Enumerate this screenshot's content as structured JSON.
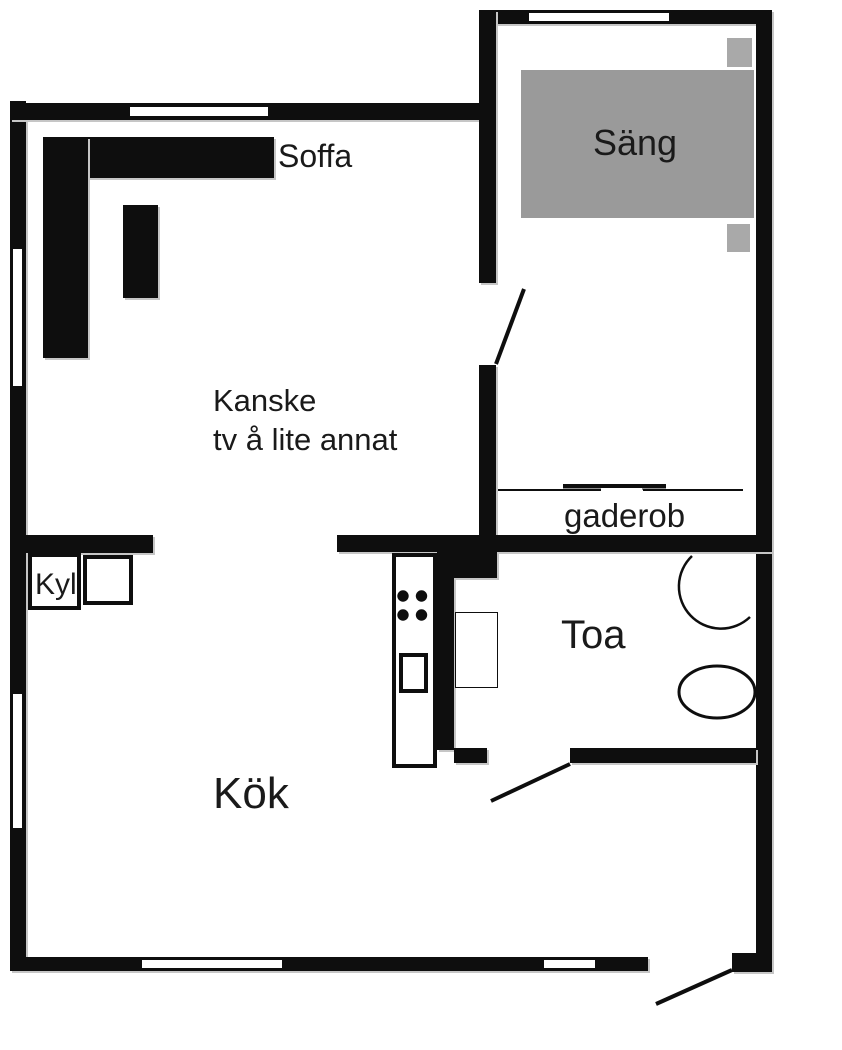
{
  "floorplan": {
    "labels": {
      "sofa": "Soffa",
      "bed": "Säng",
      "tv_note_line1": "Kanske",
      "tv_note_line2": "tv å lite annat",
      "wardrobe": "gaderob",
      "fridge": "Kyl",
      "bathroom": "Toa",
      "kitchen": "Kök"
    },
    "colors": {
      "wall": "#0e0e0e",
      "bed-fill": "#9a9a9a",
      "pillow-fill": "#a9a9a9",
      "edge-shadow": "#c6c6c6",
      "text": "#1a1a1a",
      "bg": "#ffffff"
    }
  }
}
